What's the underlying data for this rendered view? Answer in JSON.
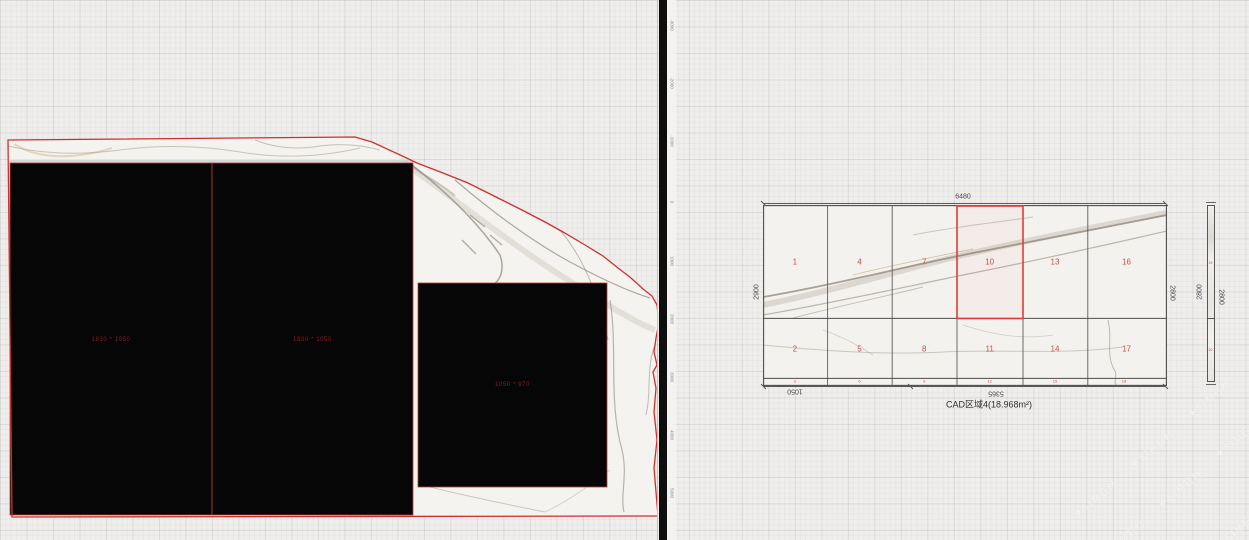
{
  "left_panel": {
    "pieces": [
      {
        "id": "piece-1",
        "label": "1830 * 1050"
      },
      {
        "id": "piece-2",
        "label": "1830 * 1050"
      },
      {
        "id": "piece-3",
        "label": "1050 * 970"
      }
    ],
    "ruler_ticks": [
      "-3000",
      "-2000",
      "-1000",
      "0",
      "1000",
      "2000",
      "3000",
      "4000",
      "5000"
    ]
  },
  "right_panel": {
    "title": "CAD区域4(18.968m²)",
    "dimensions": {
      "top": "6480",
      "left": "2900",
      "right": "2800",
      "bottom_left": "1050",
      "bottom_mid": "5365",
      "side_left": "2800",
      "side_right": "2800"
    },
    "cells": {
      "top_row": [
        "1",
        "4",
        "7",
        "10",
        "13",
        "16"
      ],
      "bottom_row": [
        "2",
        "5",
        "8",
        "11",
        "14",
        "17"
      ],
      "strip_row": [
        "3",
        "6",
        "9",
        "12",
        "15",
        "18"
      ],
      "highlighted_cell": "10",
      "side_top": "19",
      "side_bottom": "20"
    }
  },
  "watermark": {
    "icon": "❖",
    "text": "51M石材"
  },
  "colors": {
    "accent_red": "#d9332e",
    "piece_label_red": "#8c1e22",
    "cell_number_red": "#cf4b4b",
    "divider_black": "#0e0e0e",
    "dim_gray": "#4a4a4a",
    "marble_base": "#f4f2ee"
  }
}
